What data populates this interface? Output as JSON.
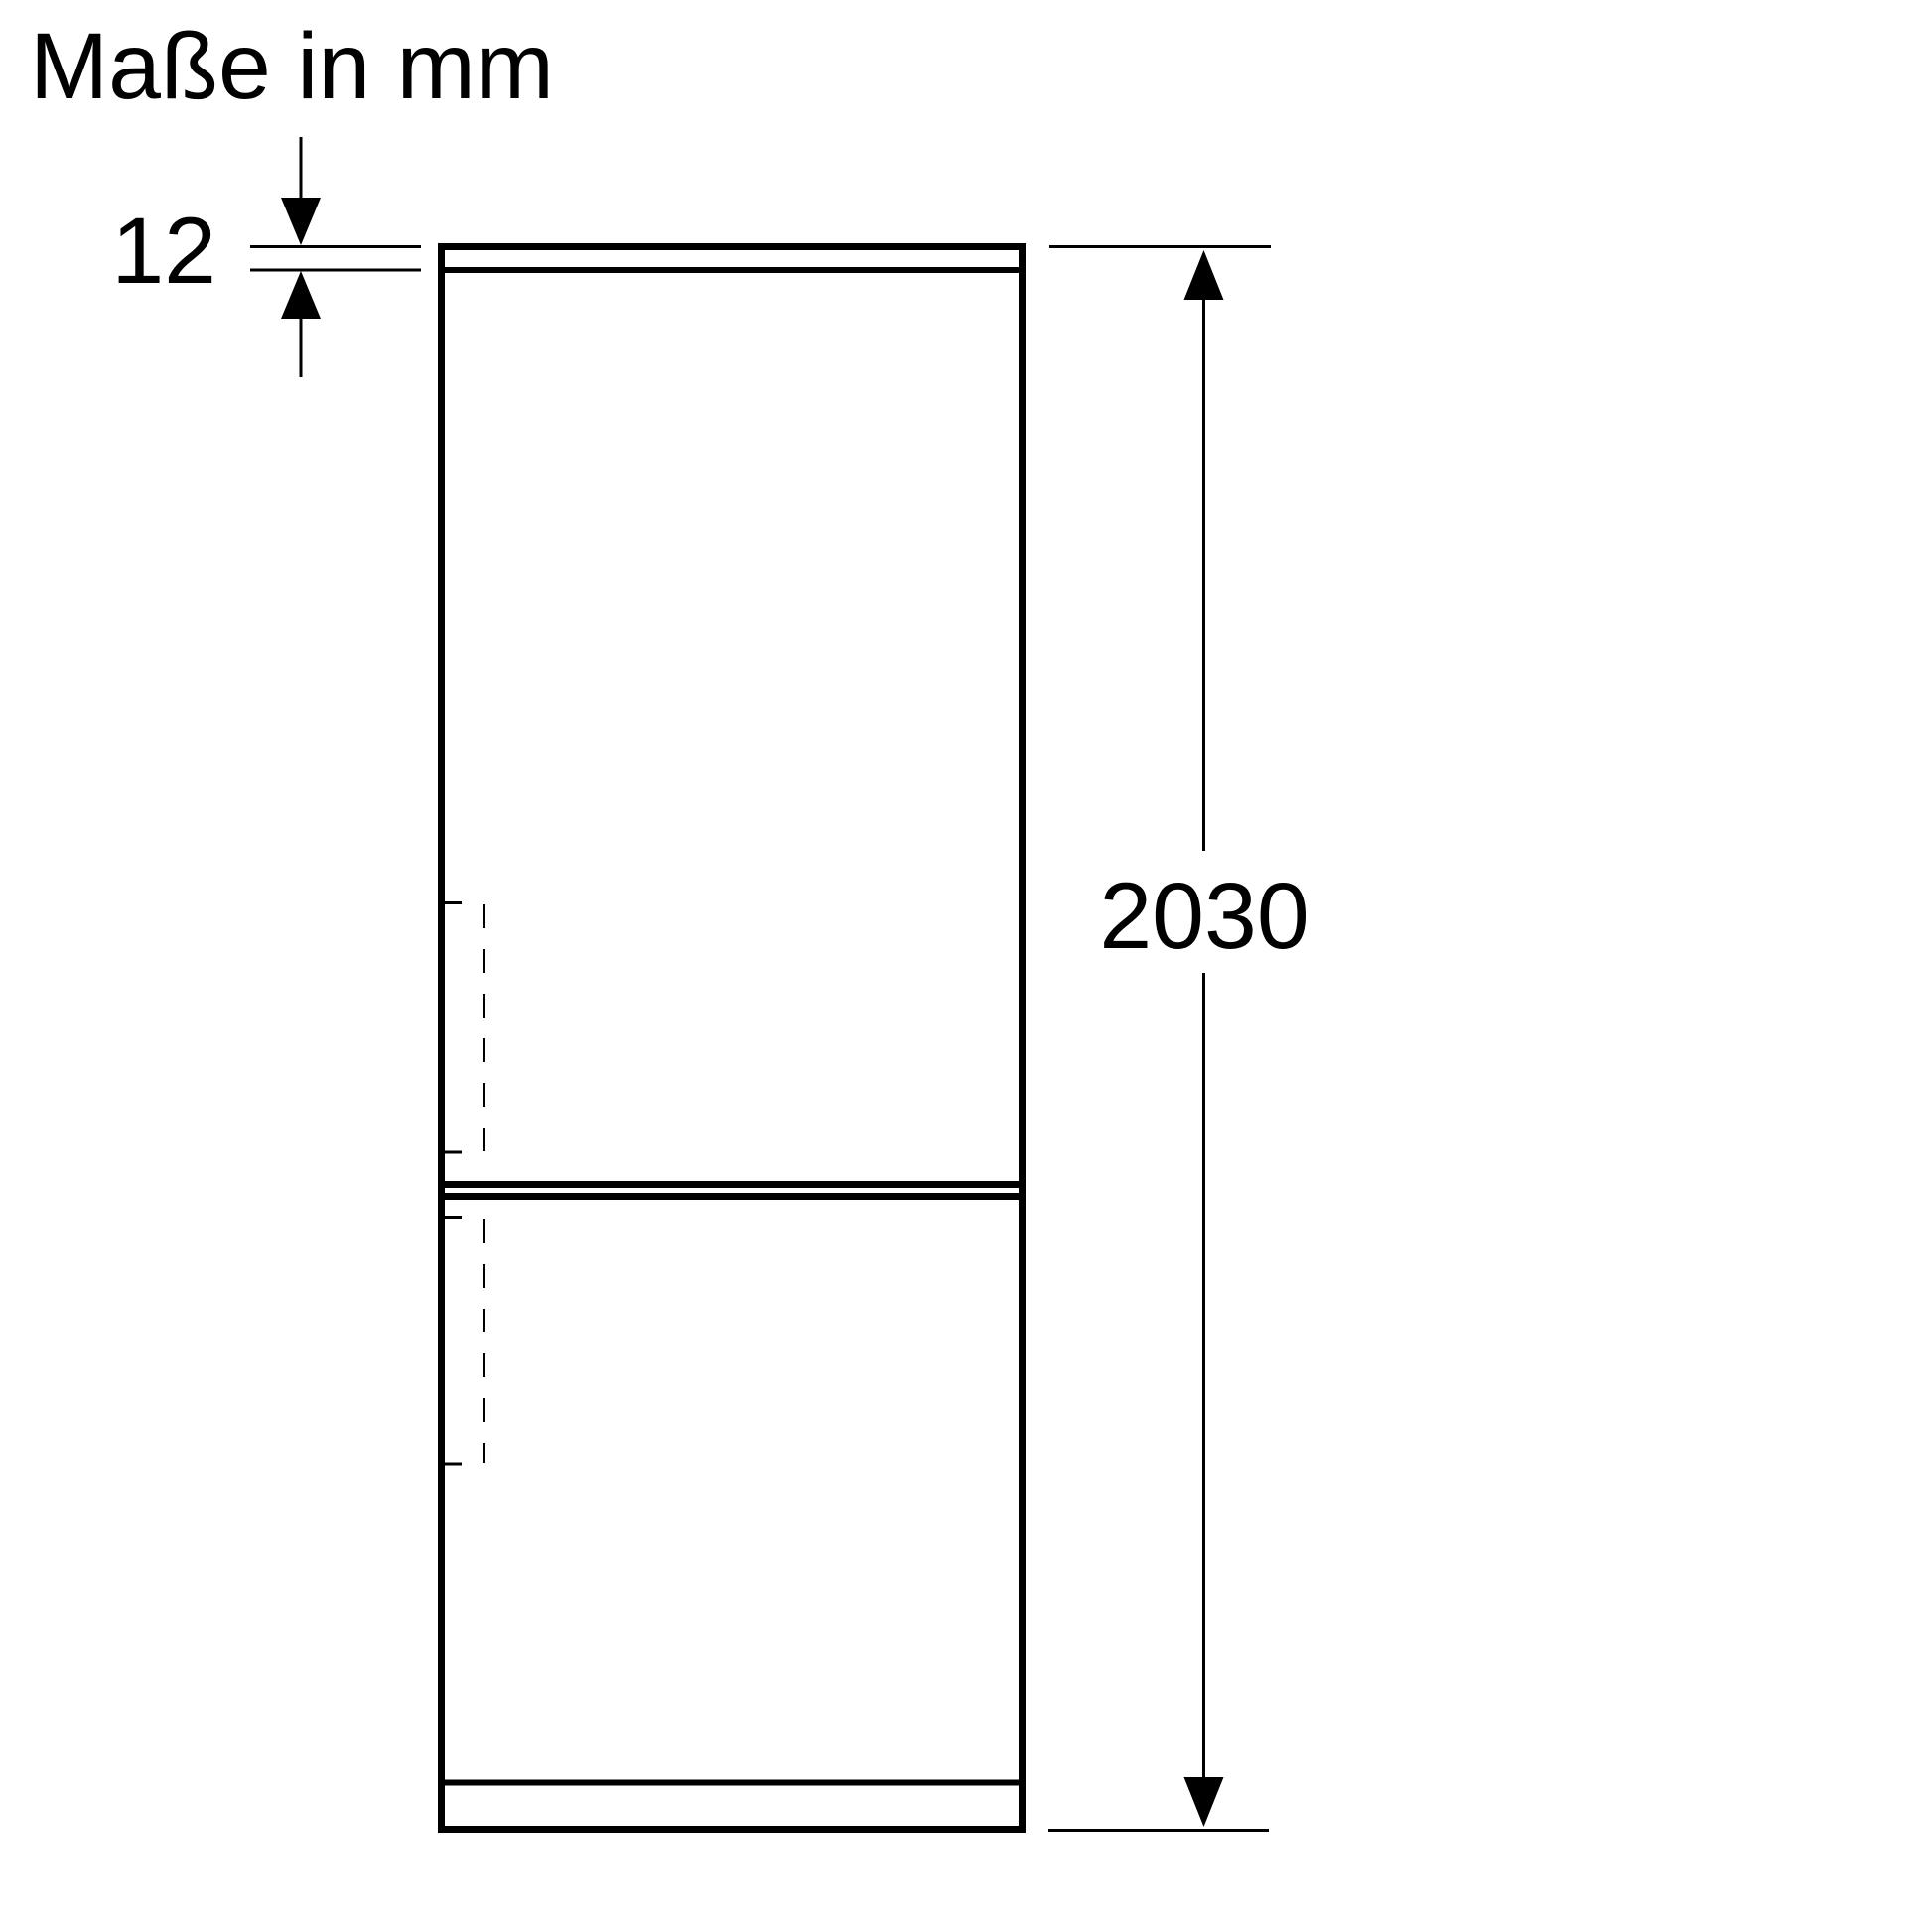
{
  "title": "Maße in mm",
  "dimensions": {
    "top_panel_thickness": {
      "value": "12"
    },
    "overall_height": {
      "value": "2030"
    }
  },
  "theme": {
    "background": "#ffffff",
    "line_color": "#000000",
    "text_color": "#000000"
  }
}
